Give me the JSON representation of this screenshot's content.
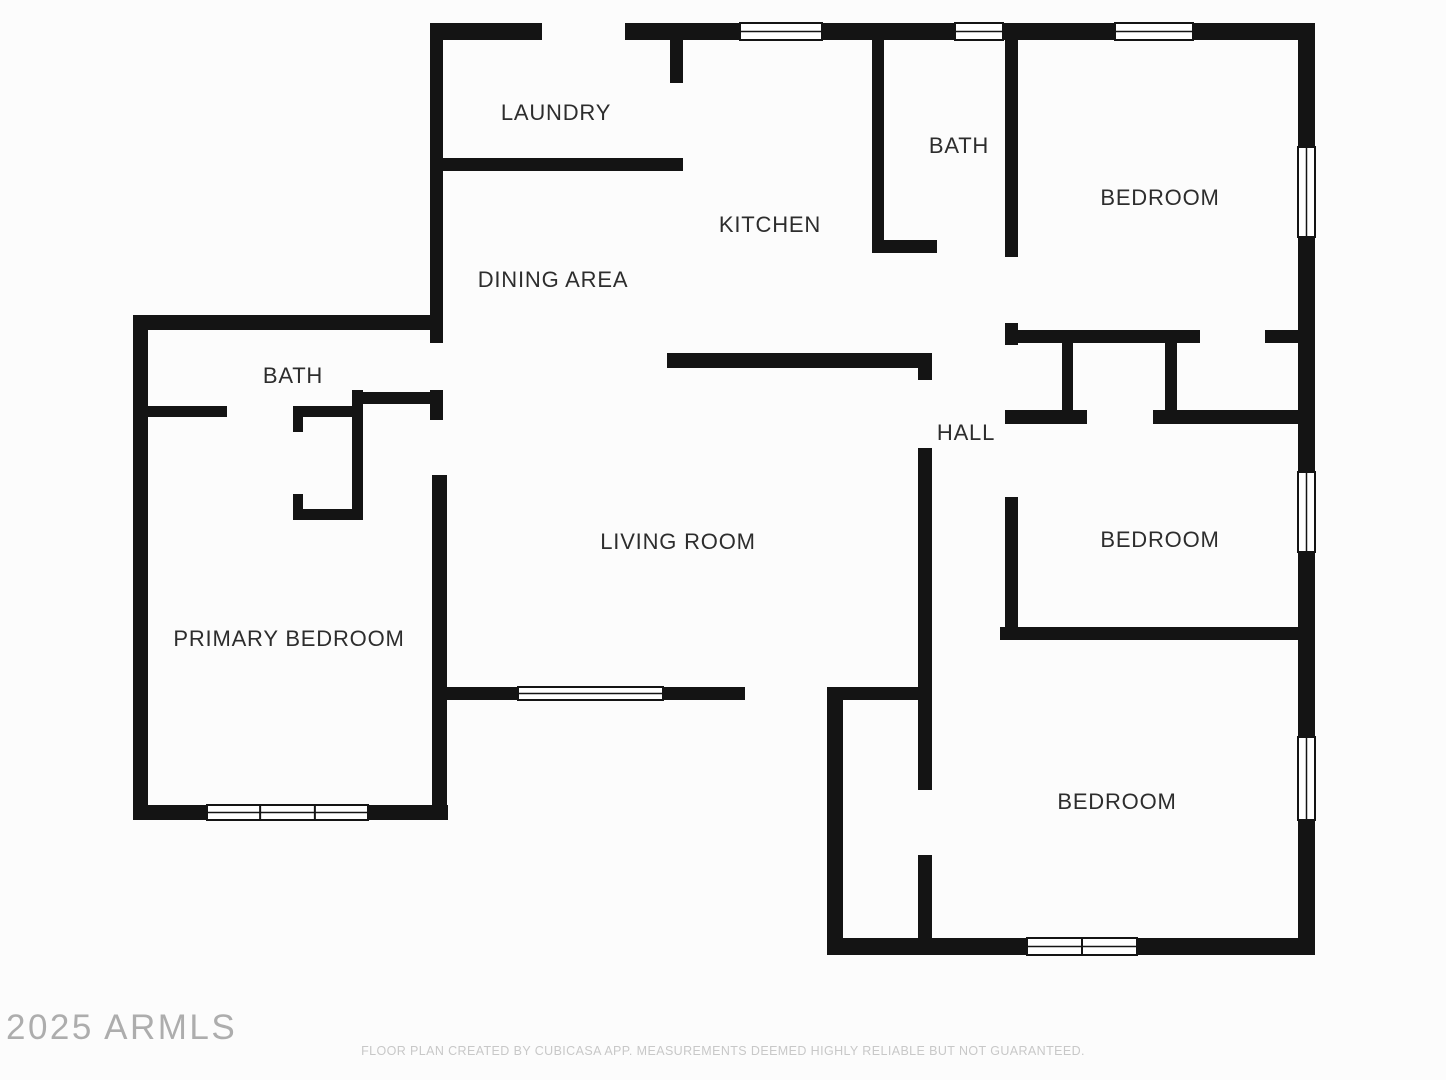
{
  "floor_plan": {
    "wall_color": "#141414",
    "room_interior_color": "#ffffff",
    "window_frame_color": "#141414",
    "rooms": [
      {
        "id": "laundry",
        "label": "LAUNDRY",
        "x": 556,
        "y": 114
      },
      {
        "id": "kitchen",
        "label": "KITCHEN",
        "x": 770,
        "y": 226
      },
      {
        "id": "bath-top",
        "label": "BATH",
        "x": 959,
        "y": 147
      },
      {
        "id": "bedroom-top",
        "label": "BEDROOM",
        "x": 1160,
        "y": 199
      },
      {
        "id": "dining-area",
        "label": "DINING AREA",
        "x": 553,
        "y": 281
      },
      {
        "id": "hall",
        "label": "HALL",
        "x": 966,
        "y": 434
      },
      {
        "id": "bath-left",
        "label": "BATH",
        "x": 293,
        "y": 377
      },
      {
        "id": "bedroom-middle",
        "label": "BEDROOM",
        "x": 1160,
        "y": 541
      },
      {
        "id": "living-room",
        "label": "LIVING ROOM",
        "x": 678,
        "y": 543
      },
      {
        "id": "primary-bedroom",
        "label": "PRIMARY BEDROOM",
        "x": 289,
        "y": 640
      },
      {
        "id": "bedroom-bottom",
        "label": "BEDROOM",
        "x": 1117,
        "y": 803
      }
    ],
    "walls": [
      [
        430,
        23,
        112,
        17
      ],
      [
        625,
        23,
        115,
        17
      ],
      [
        822,
        23,
        133,
        17
      ],
      [
        1003,
        23,
        112,
        17
      ],
      [
        1193,
        23,
        122,
        17
      ],
      [
        1298,
        23,
        17,
        124
      ],
      [
        1298,
        237,
        17,
        235
      ],
      [
        1298,
        552,
        17,
        185
      ],
      [
        1298,
        820,
        17,
        135
      ],
      [
        827,
        938,
        200,
        17
      ],
      [
        1137,
        938,
        178,
        17
      ],
      [
        430,
        23,
        13,
        147
      ],
      [
        670,
        31,
        13,
        52
      ],
      [
        430,
        158,
        253,
        13
      ],
      [
        430,
        170,
        13,
        173
      ],
      [
        430,
        390,
        13,
        30
      ],
      [
        432,
        475,
        15,
        345
      ],
      [
        133,
        315,
        302,
        15
      ],
      [
        133,
        315,
        15,
        505
      ],
      [
        133,
        805,
        74,
        15
      ],
      [
        368,
        805,
        80,
        15
      ],
      [
        148,
        406,
        79,
        11
      ],
      [
        293,
        406,
        62,
        11
      ],
      [
        293,
        406,
        10,
        26
      ],
      [
        352,
        390,
        11,
        130
      ],
      [
        293,
        509,
        70,
        11
      ],
      [
        293,
        494,
        10,
        26
      ],
      [
        353,
        392,
        85,
        12
      ],
      [
        872,
        30,
        12,
        223
      ],
      [
        872,
        240,
        65,
        13
      ],
      [
        1005,
        30,
        13,
        227
      ],
      [
        1005,
        323,
        13,
        22
      ],
      [
        667,
        353,
        263,
        15
      ],
      [
        918,
        353,
        14,
        27
      ],
      [
        918,
        448,
        14,
        240
      ],
      [
        1010,
        330,
        190,
        13
      ],
      [
        1265,
        330,
        50,
        13
      ],
      [
        1062,
        335,
        11,
        85
      ],
      [
        1165,
        335,
        12,
        85
      ],
      [
        1005,
        410,
        82,
        14
      ],
      [
        1153,
        410,
        162,
        14
      ],
      [
        1005,
        497,
        13,
        133
      ],
      [
        1000,
        627,
        315,
        13
      ],
      [
        437,
        687,
        81,
        13
      ],
      [
        663,
        687,
        82,
        13
      ],
      [
        827,
        687,
        16,
        263
      ],
      [
        842,
        687,
        80,
        13
      ],
      [
        918,
        687,
        14,
        103
      ],
      [
        918,
        855,
        14,
        95
      ]
    ],
    "windows": [
      {
        "x": 740,
        "y": 23,
        "w": 82,
        "h": 17,
        "mullions": []
      },
      {
        "x": 955,
        "y": 23,
        "w": 48,
        "h": 17,
        "mullions": []
      },
      {
        "x": 1115,
        "y": 23,
        "w": 78,
        "h": 17,
        "mullions": []
      },
      {
        "x": 1298,
        "y": 147,
        "w": 17,
        "h": 90,
        "mullions": []
      },
      {
        "x": 1298,
        "y": 472,
        "w": 17,
        "h": 80,
        "mullions": []
      },
      {
        "x": 1298,
        "y": 737,
        "w": 17,
        "h": 83,
        "mullions": []
      },
      {
        "x": 1027,
        "y": 938,
        "w": 110,
        "h": 17,
        "mullions": [
          0.5
        ]
      },
      {
        "x": 207,
        "y": 805,
        "w": 161,
        "h": 15,
        "mullions": [
          0.33,
          0.67
        ]
      },
      {
        "x": 518,
        "y": 687,
        "w": 145,
        "h": 13,
        "mullions": []
      }
    ]
  },
  "watermark": {
    "text": "2025 ARMLS"
  },
  "footer": {
    "disclaimer": "FLOOR PLAN CREATED BY CUBICASA APP. MEASUREMENTS DEEMED HIGHLY RELIABLE BUT NOT GUARANTEED."
  }
}
